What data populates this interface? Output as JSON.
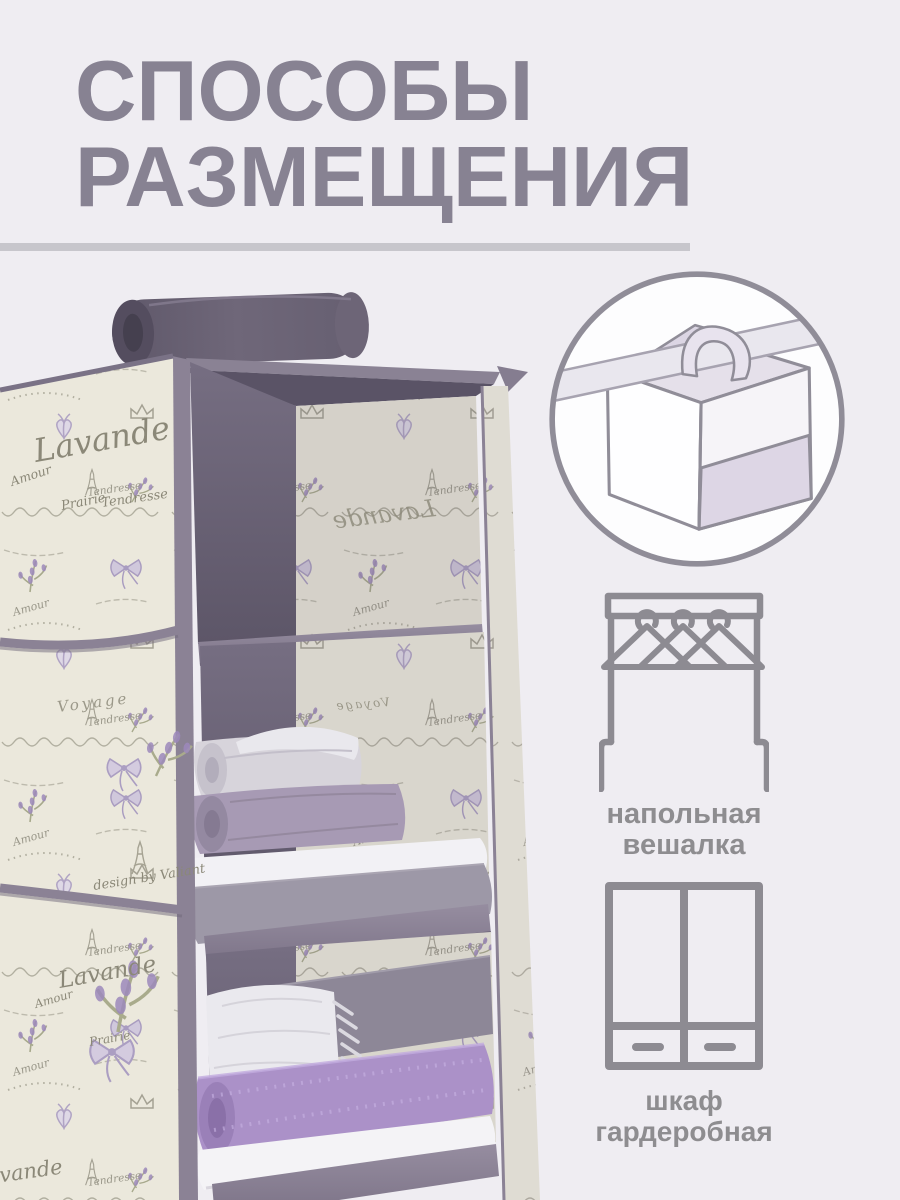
{
  "palette": {
    "background": "#efedf2",
    "title_text": "#878292",
    "divider": "#c7c6cc",
    "icon_stroke": "#8d8b92",
    "label_text": "#8e8d90",
    "circle_fill": "#fdfdfe",
    "fabric_dark": "#6b6375",
    "fabric_edge": "#8b8295",
    "pattern_cream": "#f0eddf",
    "pattern_ink": "#9b9889",
    "lavender": "#9d89bc",
    "towel_purple": "#ab91c8"
  },
  "header": {
    "title_line1": "СПОСОБЫ",
    "title_line2": "РАЗМЕЩЕНИЯ"
  },
  "placement_methods": [
    {
      "id": "closet-rod",
      "type": "illustration"
    },
    {
      "id": "floor-hanger",
      "label_line1": "напольная",
      "label_line2": "вешалка"
    },
    {
      "id": "wardrobe",
      "label_line1": "шкаф",
      "label_line2": "гардеробная"
    }
  ],
  "product_photo": {
    "pattern_words": {
      "w1": "Lavande",
      "w2": "Amour",
      "w3": "Prairie",
      "w4": "Tendresse",
      "w5": "Voyage",
      "w6": "design by Valiant"
    }
  }
}
